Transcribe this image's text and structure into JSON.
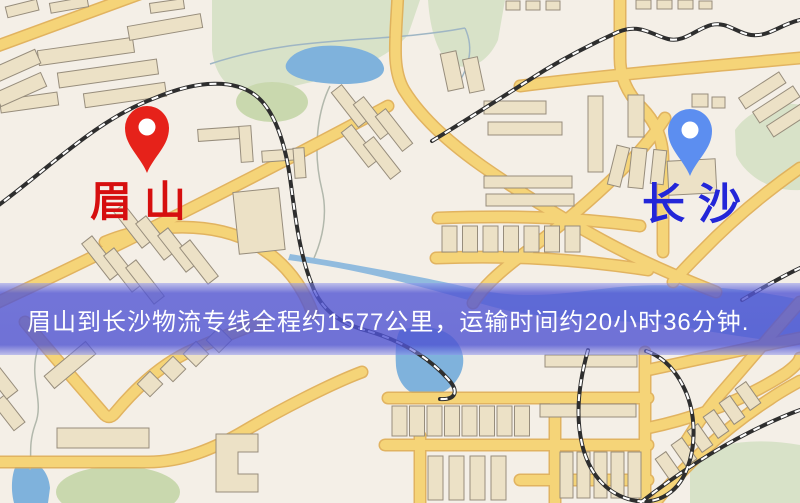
{
  "map": {
    "origin_marker": {
      "label": "眉山",
      "pin_color": "#e6221a",
      "label_color": "#d60f0f"
    },
    "destination_marker": {
      "label": "长沙",
      "pin_color": "#5c8ef0",
      "label_color": "#2326d8"
    },
    "banner": {
      "text": "眉山到长沙物流专线全程约1577公里，运输时间约20小时36分钟.",
      "background": "#5458d6",
      "text_color": "#ffffff"
    },
    "colors": {
      "background": "#f4efe7",
      "road": "#f5d478",
      "road_casing": "#e0ad52",
      "building": "#ece1c6",
      "park": "#d8e2c8",
      "water": "#7fb2dc",
      "railway": "#2e2e2e"
    }
  }
}
